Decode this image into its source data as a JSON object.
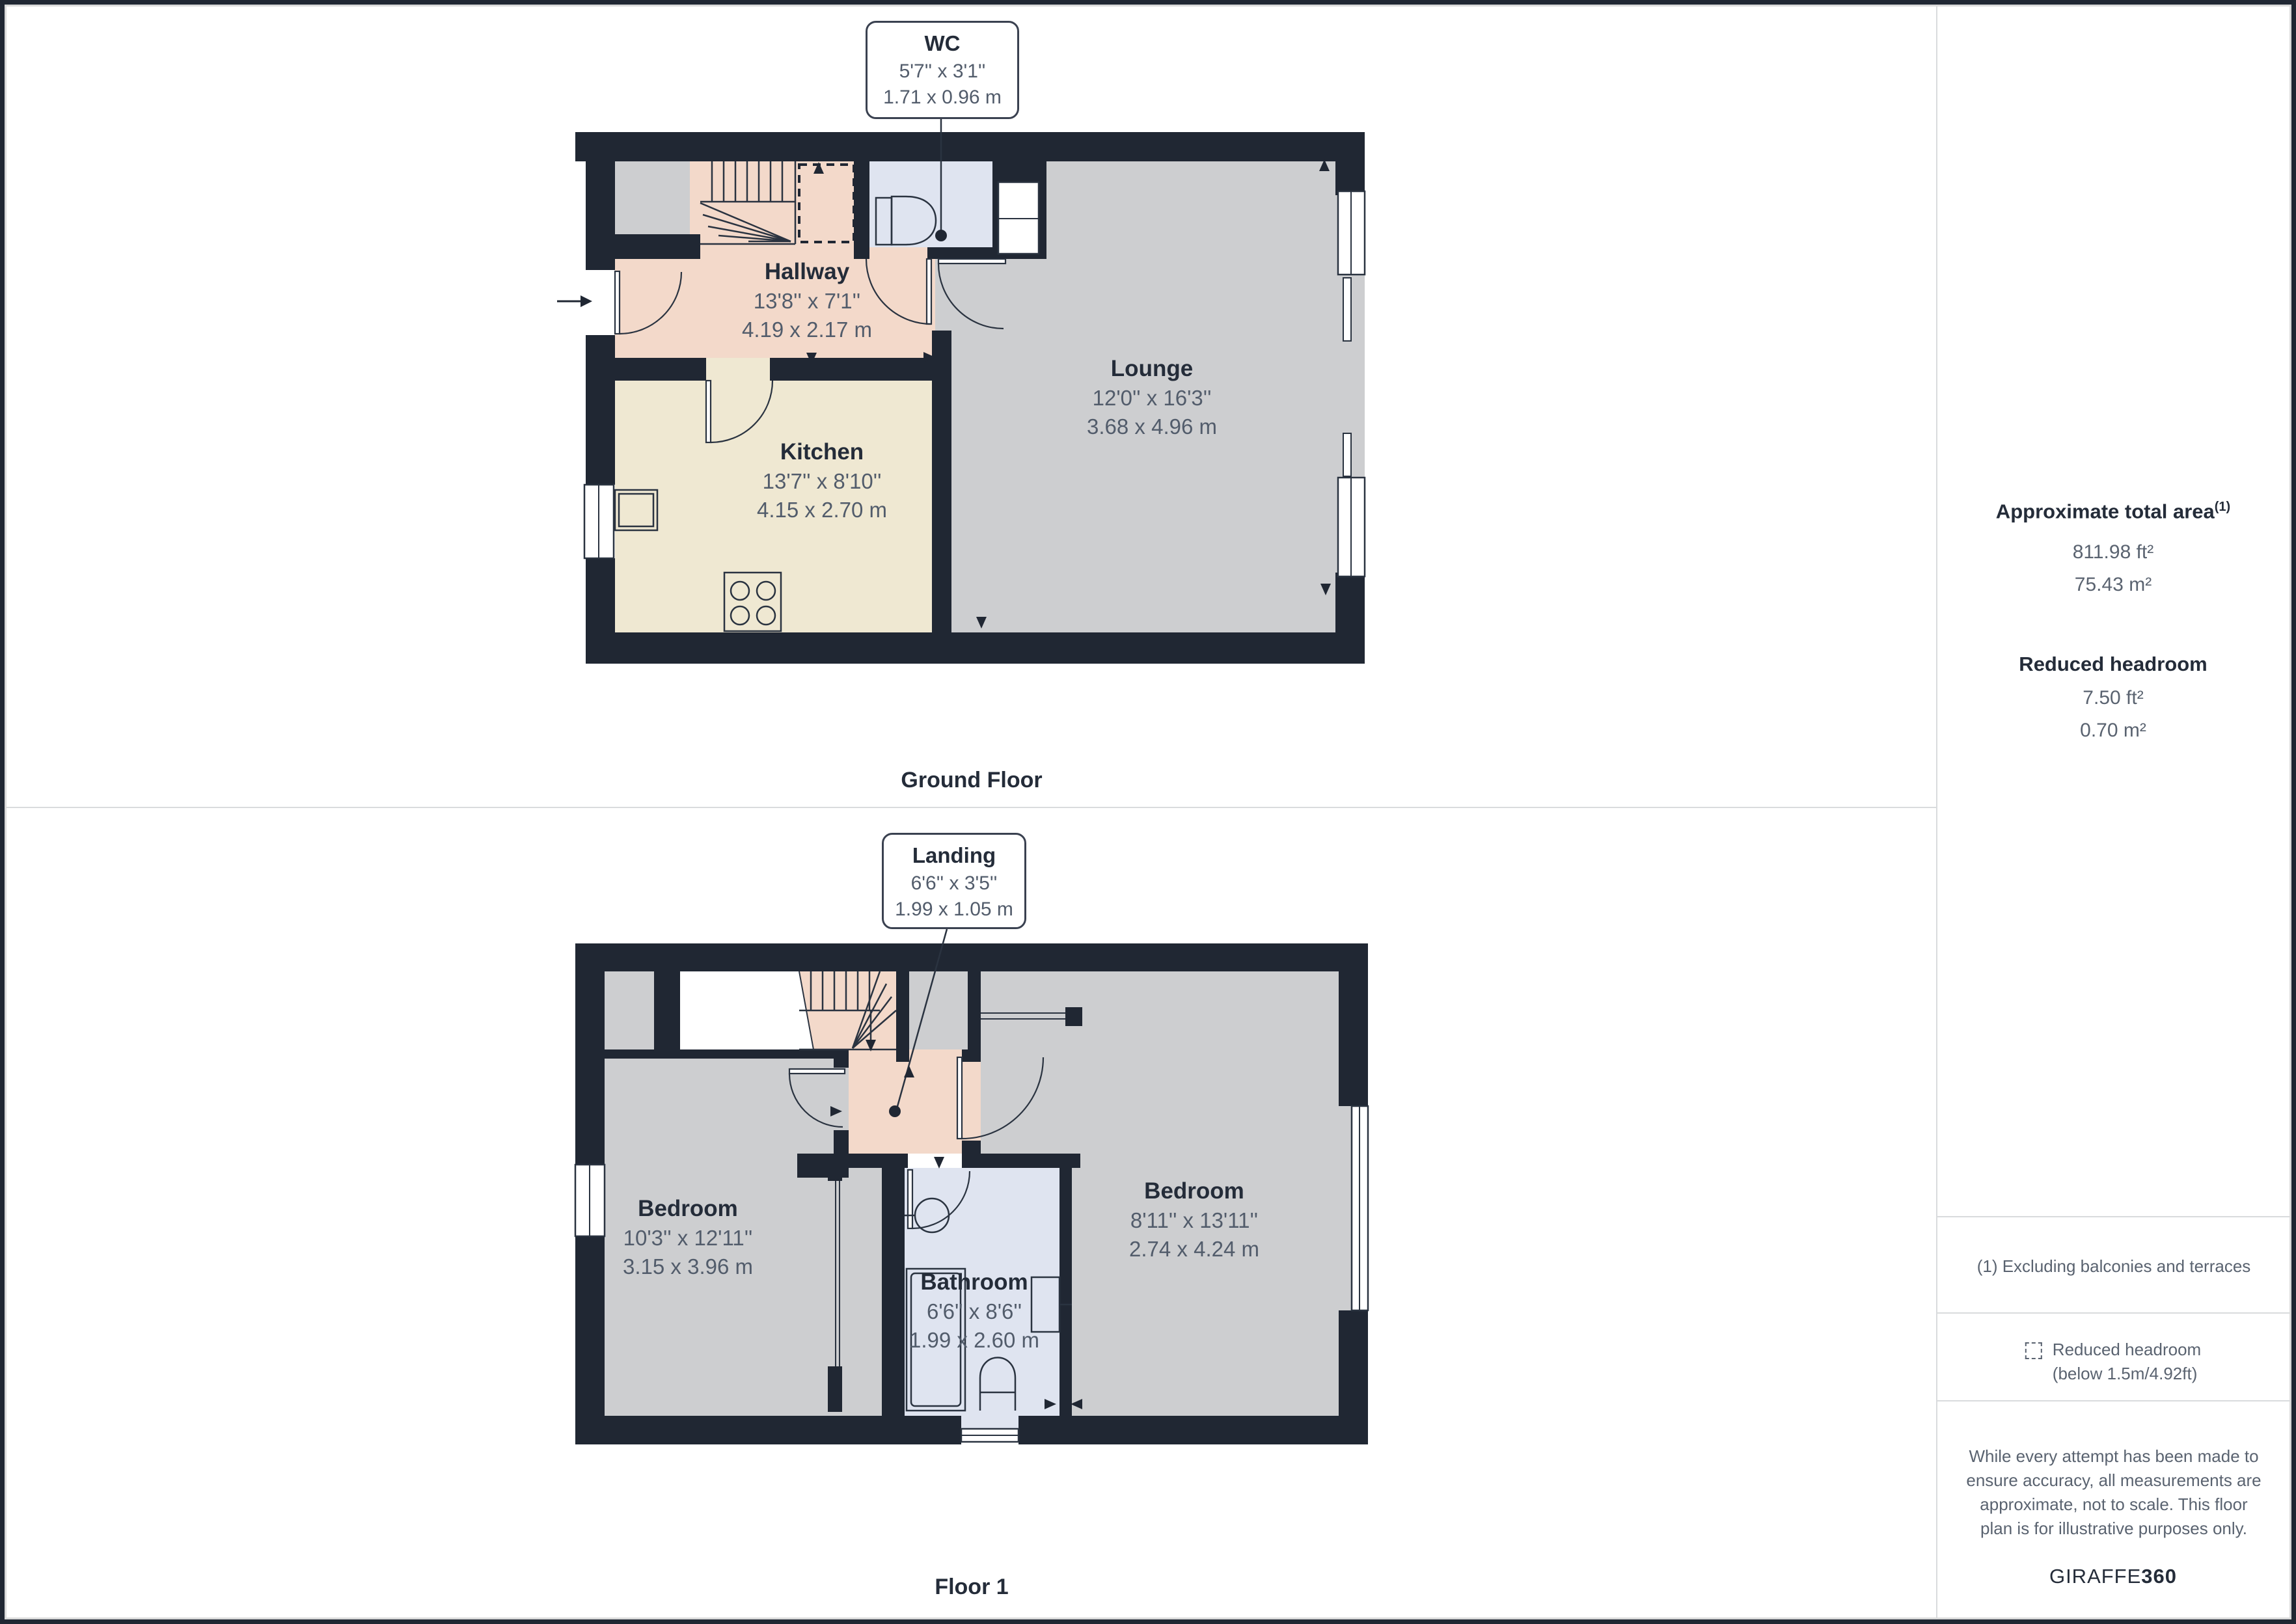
{
  "ground_floor": {
    "caption": "Ground Floor",
    "callout": {
      "room": "WC",
      "imperial": "5'7'' x 3'1''",
      "metric": "1.71 x 0.96 m"
    },
    "rooms": [
      {
        "name": "Hallway",
        "imperial": "13'8'' x 7'1''",
        "metric": "4.19 x 2.17 m"
      },
      {
        "name": "Kitchen",
        "imperial": "13'7'' x 8'10''",
        "metric": "4.15 x 2.70 m"
      },
      {
        "name": "Lounge",
        "imperial": "12'0'' x 16'3''",
        "metric": "3.68 x 4.96 m"
      }
    ]
  },
  "floor_1": {
    "caption": "Floor 1",
    "callout": {
      "room": "Landing",
      "imperial": "6'6'' x 3'5''",
      "metric": "1.99 x 1.05 m"
    },
    "rooms": [
      {
        "name": "Bedroom",
        "imperial": "10'3'' x 12'11''",
        "metric": "3.15 x 3.96 m"
      },
      {
        "name": "Bathroom",
        "imperial": "6'6'' x 8'6''",
        "metric": "1.99 x 2.60 m"
      },
      {
        "name": "Bedroom",
        "imperial": "8'11'' x 13'11''",
        "metric": "2.74 x 4.24 m"
      }
    ]
  },
  "sidebar": {
    "total_area": {
      "label": "Approximate total area",
      "marker": "(1)",
      "imperial": "811.98 ft²",
      "metric": "75.43 m²"
    },
    "reduced_headroom": {
      "label": "Reduced headroom",
      "imperial": "7.50 ft²",
      "metric": "0.70 m²"
    },
    "footnote": "(1) Excluding balconies and terraces",
    "legend": {
      "line1": "Reduced headroom",
      "line2": "(below 1.5m/4.92ft)",
      "icon": "dashed-square"
    },
    "disclaimer": {
      "line1": "While every attempt has been made to",
      "line2": "ensure accuracy, all measurements are",
      "line3": "approximate, not to scale. This floor",
      "line4": "plan is for illustrative purposes only.",
      "brand_light": "GIRAFFE",
      "brand_bold": "360"
    }
  },
  "colors": {
    "wall": "#202733",
    "hall_landing": "#f3d9ca",
    "kitchen": "#efe8d2",
    "living": "#cdced0",
    "bath": "#dfe4f0",
    "accent_text": "#242c39",
    "dim_text": "#525c6b"
  }
}
